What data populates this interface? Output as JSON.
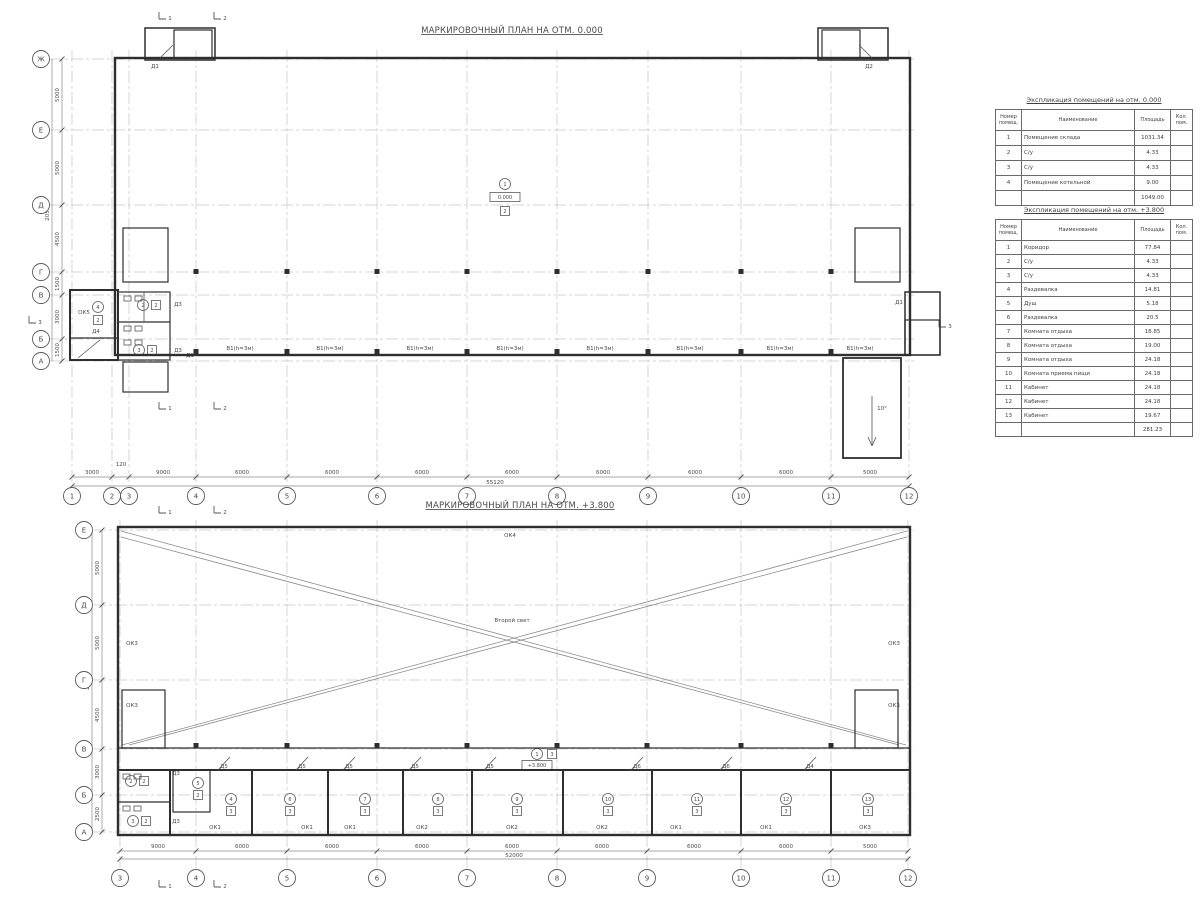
{
  "plans": [
    {
      "name": "markup-plan-0.000",
      "title": "МАРКИРОВОЧНЫЙ ПЛАН НА ОТМ. 0.000",
      "grid_columns": [
        {
          "label": "1",
          "x": 72
        },
        {
          "label": "2",
          "x": 112
        },
        {
          "label": "3",
          "x": 129
        },
        {
          "label": "4",
          "x": 196
        },
        {
          "label": "5",
          "x": 287
        },
        {
          "label": "6",
          "x": 377
        },
        {
          "label": "7",
          "x": 467
        },
        {
          "label": "8",
          "x": 557
        },
        {
          "label": "9",
          "x": 648
        },
        {
          "label": "10",
          "x": 741
        },
        {
          "label": "11",
          "x": 831
        },
        {
          "label": "12",
          "x": 909
        }
      ],
      "grid_rows": [
        {
          "label": "Ж",
          "y": 59
        },
        {
          "label": "Е",
          "y": 130
        },
        {
          "label": "Д",
          "y": 205
        },
        {
          "label": "Г",
          "y": 272
        },
        {
          "label": "В",
          "y": 295
        },
        {
          "label": "Б",
          "y": 339
        },
        {
          "label": "А",
          "y": 361
        }
      ],
      "dims_bottom": {
        "segments": [
          {
            "label": "3000",
            "x": 92
          },
          {
            "label": "120",
            "x": 121,
            "y": 466
          },
          {
            "label": "9000",
            "x": 163
          },
          {
            "label": "6000",
            "x": 242
          },
          {
            "label": "6000",
            "x": 332
          },
          {
            "label": "6000",
            "x": 422
          },
          {
            "label": "6000",
            "x": 512
          },
          {
            "label": "6000",
            "x": 603
          },
          {
            "label": "6000",
            "x": 695
          },
          {
            "label": "6000",
            "x": 786
          },
          {
            "label": "5000",
            "x": 870
          }
        ],
        "total": {
          "label": "55120",
          "x": 495
        }
      },
      "dims_left": {
        "segments": [
          {
            "label": "5000",
            "y": 95
          },
          {
            "label": "5000",
            "y": 168
          },
          {
            "label": "4500",
            "y": 239
          },
          {
            "label": "1500",
            "y": 284
          },
          {
            "label": "3000",
            "y": 317
          },
          {
            "label": "1500",
            "y": 350
          }
        ],
        "total": {
          "label": "20500",
          "y": 212
        }
      },
      "labels": [
        {
          "kind": "plain",
          "text": "Д1",
          "x": 155,
          "y": 68
        },
        {
          "kind": "plain",
          "text": "Д2",
          "x": 869,
          "y": 68
        },
        {
          "kind": "plain",
          "text": "Д3",
          "x": 178,
          "y": 306
        },
        {
          "kind": "plain",
          "text": "Д3",
          "x": 178,
          "y": 352
        },
        {
          "kind": "plain",
          "text": "Д1",
          "x": 190,
          "y": 357
        },
        {
          "kind": "plain",
          "text": "Д4",
          "x": 96,
          "y": 333
        },
        {
          "kind": "plain",
          "text": "Д1",
          "x": 899,
          "y": 304
        },
        {
          "kind": "plain",
          "text": "ОК5",
          "x": 84,
          "y": 314
        },
        {
          "kind": "plain",
          "text": "10°",
          "x": 882,
          "y": 410
        },
        {
          "kind": "window",
          "text": "В1(h=3м)",
          "x": 240,
          "y": 350
        },
        {
          "kind": "window",
          "text": "В1(h=3м)",
          "x": 330,
          "y": 350
        },
        {
          "kind": "window",
          "text": "В1(h=3м)",
          "x": 420,
          "y": 350
        },
        {
          "kind": "window",
          "text": "В1(h=3м)",
          "x": 510,
          "y": 350
        },
        {
          "kind": "window",
          "text": "В1(h=3м)",
          "x": 600,
          "y": 350
        },
        {
          "kind": "window",
          "text": "В1(h=3м)",
          "x": 690,
          "y": 350
        },
        {
          "kind": "window",
          "text": "В1(h=3м)",
          "x": 780,
          "y": 350
        },
        {
          "kind": "window",
          "text": "В1(h=3м)",
          "x": 860,
          "y": 350
        },
        {
          "kind": "circle",
          "text": "1",
          "x": 505,
          "y": 184
        },
        {
          "kind": "box",
          "text": "0.000",
          "x": 505,
          "y": 197
        },
        {
          "kind": "square",
          "text": "2",
          "x": 505,
          "y": 211
        },
        {
          "kind": "circle",
          "text": "4",
          "x": 98,
          "y": 307
        },
        {
          "kind": "square",
          "text": "2",
          "x": 98,
          "y": 320
        },
        {
          "kind": "circle",
          "text": "2",
          "x": 143,
          "y": 305
        },
        {
          "kind": "square",
          "text": "2",
          "x": 156,
          "y": 305
        },
        {
          "kind": "circle",
          "text": "3",
          "x": 139,
          "y": 350
        },
        {
          "kind": "square",
          "text": "2",
          "x": 152,
          "y": 350
        },
        {
          "kind": "section",
          "text": "1",
          "x": 168,
          "y": 16
        },
        {
          "kind": "section",
          "text": "2",
          "x": 223,
          "y": 16
        },
        {
          "kind": "section",
          "text": "1",
          "x": 168,
          "y": 406
        },
        {
          "kind": "section",
          "text": "2",
          "x": 223,
          "y": 406
        },
        {
          "kind": "section",
          "text": "3",
          "x": 38,
          "y": 320
        },
        {
          "kind": "section",
          "text": "3",
          "x": 948,
          "y": 324
        }
      ]
    },
    {
      "name": "markup-plan-+3.800",
      "title": "МАРКИРОВОЧНЫЙ ПЛАН НА ОТМ. +3.800",
      "grid_columns": [
        {
          "label": "3",
          "x": 120
        },
        {
          "label": "4",
          "x": 196
        },
        {
          "label": "5",
          "x": 287
        },
        {
          "label": "6",
          "x": 377
        },
        {
          "label": "7",
          "x": 467
        },
        {
          "label": "8",
          "x": 557
        },
        {
          "label": "9",
          "x": 647
        },
        {
          "label": "10",
          "x": 741
        },
        {
          "label": "11",
          "x": 831
        },
        {
          "label": "12",
          "x": 908
        }
      ],
      "grid_rows": [
        {
          "label": "Е",
          "y": 530
        },
        {
          "label": "Д",
          "y": 605
        },
        {
          "label": "Г",
          "y": 680
        },
        {
          "label": "В",
          "y": 749
        },
        {
          "label": "Б",
          "y": 795
        },
        {
          "label": "А",
          "y": 832
        }
      ],
      "dims_bottom": {
        "segments": [
          {
            "label": "9000",
            "x": 158
          },
          {
            "label": "6000",
            "x": 242
          },
          {
            "label": "6000",
            "x": 332
          },
          {
            "label": "6000",
            "x": 422
          },
          {
            "label": "6000",
            "x": 512
          },
          {
            "label": "6000",
            "x": 602
          },
          {
            "label": "6000",
            "x": 694
          },
          {
            "label": "6000",
            "x": 786
          },
          {
            "label": "5000",
            "x": 870
          }
        ],
        "total": {
          "label": "52000",
          "x": 514
        }
      },
      "dims_left": {
        "segments": [
          {
            "label": "5000",
            "y": 568
          },
          {
            "label": "5000",
            "y": 643
          },
          {
            "label": "4500",
            "y": 715
          },
          {
            "label": "3000",
            "y": 772
          },
          {
            "label": "2500",
            "y": 814
          }
        ],
        "total": {
          "label": "20000",
          "y": 681
        }
      },
      "labels": [
        {
          "kind": "plain",
          "text": "ОК4",
          "x": 510,
          "y": 537
        },
        {
          "kind": "plain",
          "text": "Второй свет",
          "x": 512,
          "y": 622
        },
        {
          "kind": "plain",
          "text": "ОК3",
          "x": 132,
          "y": 645
        },
        {
          "kind": "plain",
          "text": "ОК3",
          "x": 894,
          "y": 645
        },
        {
          "kind": "plain",
          "text": "ОК3",
          "x": 132,
          "y": 707
        },
        {
          "kind": "plain",
          "text": "ОК3",
          "x": 894,
          "y": 707
        },
        {
          "kind": "plain",
          "text": "Д3",
          "x": 176,
          "y": 775
        },
        {
          "kind": "plain",
          "text": "Д3",
          "x": 176,
          "y": 823
        },
        {
          "kind": "plain",
          "text": "Д5",
          "x": 224,
          "y": 768
        },
        {
          "kind": "plain",
          "text": "Д5",
          "x": 302,
          "y": 768
        },
        {
          "kind": "plain",
          "text": "Д5",
          "x": 349,
          "y": 768
        },
        {
          "kind": "plain",
          "text": "Д5",
          "x": 415,
          "y": 768
        },
        {
          "kind": "plain",
          "text": "Д5",
          "x": 490,
          "y": 768
        },
        {
          "kind": "plain",
          "text": "Д6",
          "x": 637,
          "y": 768
        },
        {
          "kind": "plain",
          "text": "Д6",
          "x": 726,
          "y": 768
        },
        {
          "kind": "plain",
          "text": "Д4",
          "x": 810,
          "y": 768
        },
        {
          "kind": "window",
          "text": "ОК1",
          "x": 215,
          "y": 829
        },
        {
          "kind": "window",
          "text": "ОК1",
          "x": 307,
          "y": 829
        },
        {
          "kind": "window",
          "text": "ОК1",
          "x": 350,
          "y": 829
        },
        {
          "kind": "window",
          "text": "ОК2",
          "x": 422,
          "y": 829
        },
        {
          "kind": "window",
          "text": "ОК2",
          "x": 512,
          "y": 829
        },
        {
          "kind": "window",
          "text": "ОК2",
          "x": 602,
          "y": 829
        },
        {
          "kind": "window",
          "text": "ОК1",
          "x": 676,
          "y": 829
        },
        {
          "kind": "window",
          "text": "ОК1",
          "x": 766,
          "y": 829
        },
        {
          "kind": "window",
          "text": "ОК3",
          "x": 865,
          "y": 829
        },
        {
          "kind": "circle",
          "text": "1",
          "x": 537,
          "y": 754
        },
        {
          "kind": "square",
          "text": "3",
          "x": 552,
          "y": 754
        },
        {
          "kind": "box",
          "text": "+3.800",
          "x": 537,
          "y": 765
        },
        {
          "kind": "circle",
          "text": "2",
          "x": 131,
          "y": 781
        },
        {
          "kind": "square",
          "text": "2",
          "x": 144,
          "y": 781
        },
        {
          "kind": "circle",
          "text": "3",
          "x": 133,
          "y": 821
        },
        {
          "kind": "square",
          "text": "2",
          "x": 146,
          "y": 821
        },
        {
          "kind": "circle",
          "text": "5",
          "x": 198,
          "y": 783
        },
        {
          "kind": "square",
          "text": "2",
          "x": 198,
          "y": 795
        },
        {
          "kind": "circle",
          "text": "4",
          "x": 231,
          "y": 799
        },
        {
          "kind": "square",
          "text": "3",
          "x": 231,
          "y": 811
        },
        {
          "kind": "circle",
          "text": "6",
          "x": 290,
          "y": 799
        },
        {
          "kind": "square",
          "text": "3",
          "x": 290,
          "y": 811
        },
        {
          "kind": "circle",
          "text": "7",
          "x": 365,
          "y": 799
        },
        {
          "kind": "square",
          "text": "3",
          "x": 365,
          "y": 811
        },
        {
          "kind": "circle",
          "text": "8",
          "x": 438,
          "y": 799
        },
        {
          "kind": "square",
          "text": "3",
          "x": 438,
          "y": 811
        },
        {
          "kind": "circle",
          "text": "9",
          "x": 517,
          "y": 799
        },
        {
          "kind": "square",
          "text": "3",
          "x": 517,
          "y": 811
        },
        {
          "kind": "circle",
          "text": "10",
          "x": 608,
          "y": 799
        },
        {
          "kind": "square",
          "text": "3",
          "x": 608,
          "y": 811
        },
        {
          "kind": "circle",
          "text": "11",
          "x": 697,
          "y": 799
        },
        {
          "kind": "square",
          "text": "3",
          "x": 697,
          "y": 811
        },
        {
          "kind": "circle",
          "text": "12",
          "x": 786,
          "y": 799
        },
        {
          "kind": "square",
          "text": "3",
          "x": 786,
          "y": 811
        },
        {
          "kind": "circle",
          "text": "13",
          "x": 868,
          "y": 799
        },
        {
          "kind": "square",
          "text": "3",
          "x": 868,
          "y": 811
        },
        {
          "kind": "section",
          "text": "1",
          "x": 168,
          "y": 510
        },
        {
          "kind": "section",
          "text": "2",
          "x": 223,
          "y": 510
        },
        {
          "kind": "section",
          "text": "1",
          "x": 168,
          "y": 884
        },
        {
          "kind": "section",
          "text": "2",
          "x": 223,
          "y": 884
        }
      ]
    }
  ],
  "tables": [
    {
      "title": "Экспликация помещений на отм. 0.000",
      "headers": [
        "Номер помещ.",
        "Наименование",
        "Площадь",
        "Кол. пом."
      ],
      "rows": [
        [
          "1",
          "Помещение склада",
          "1031.34",
          ""
        ],
        [
          "2",
          "С/у",
          "4.33",
          ""
        ],
        [
          "3",
          "С/у",
          "4.33",
          ""
        ],
        [
          "4",
          "Помещение котельной",
          "9.00",
          ""
        ]
      ],
      "total": "1049.00"
    },
    {
      "title": "Экспликация помещений на отм. +3.800",
      "headers": [
        "Номер помещ.",
        "Наименование",
        "Площадь",
        "Кол. пом."
      ],
      "rows": [
        [
          "1",
          "Коридор",
          "77.84",
          ""
        ],
        [
          "2",
          "С/у",
          "4.33",
          ""
        ],
        [
          "3",
          "С/у",
          "4.33",
          ""
        ],
        [
          "4",
          "Раздевалка",
          "14.81",
          ""
        ],
        [
          "5",
          "Душ",
          "5.18",
          ""
        ],
        [
          "6",
          "Раздевалка",
          "20.5",
          ""
        ],
        [
          "7",
          "Комната отдыха",
          "18.85",
          ""
        ],
        [
          "8",
          "Комната отдыха",
          "19.00",
          ""
        ],
        [
          "9",
          "Комната отдыха",
          "24.18",
          ""
        ],
        [
          "10",
          "Комната приема пищи",
          "24.18",
          ""
        ],
        [
          "11",
          "Кабинет",
          "24.18",
          ""
        ],
        [
          "12",
          "Кабинет",
          "24.18",
          ""
        ],
        [
          "13",
          "Кабинет",
          "19.67",
          ""
        ]
      ],
      "total": "281.23"
    }
  ]
}
